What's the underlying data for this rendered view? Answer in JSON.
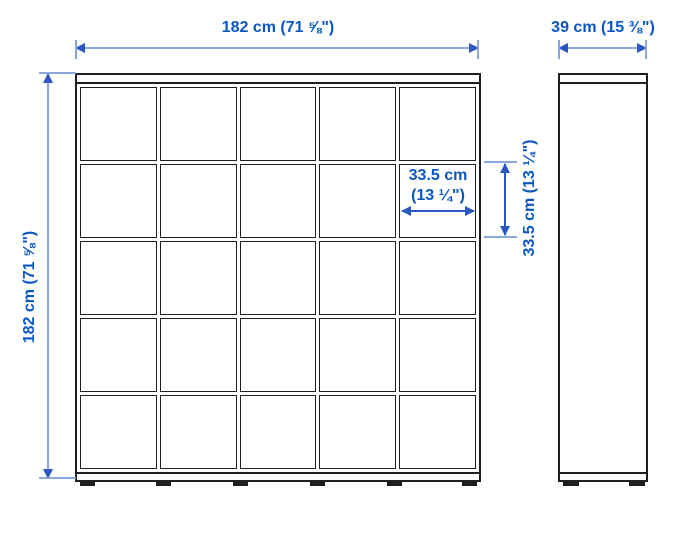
{
  "diagram": {
    "front_view": {
      "grid_rows": 5,
      "grid_cols": 5,
      "width_dimension": "182 cm (71 ⅝\")",
      "height_dimension": "182 cm (71 ⅝\")",
      "cube_width_dimension_line1": "33.5 cm",
      "cube_width_dimension_line2": "(13 ¼\")",
      "cube_height_dimension": "33.5 cm (13 ¼\")"
    },
    "side_view": {
      "depth_dimension": "39 cm (15 ⅜\")"
    },
    "colors": {
      "dimension_text": "#0b57c2",
      "dimension_line_light": "#8aa6dc",
      "dimension_arrow": "#2a57c0",
      "drawing_line": "#1f1f1f",
      "background": "#ffffff"
    }
  }
}
